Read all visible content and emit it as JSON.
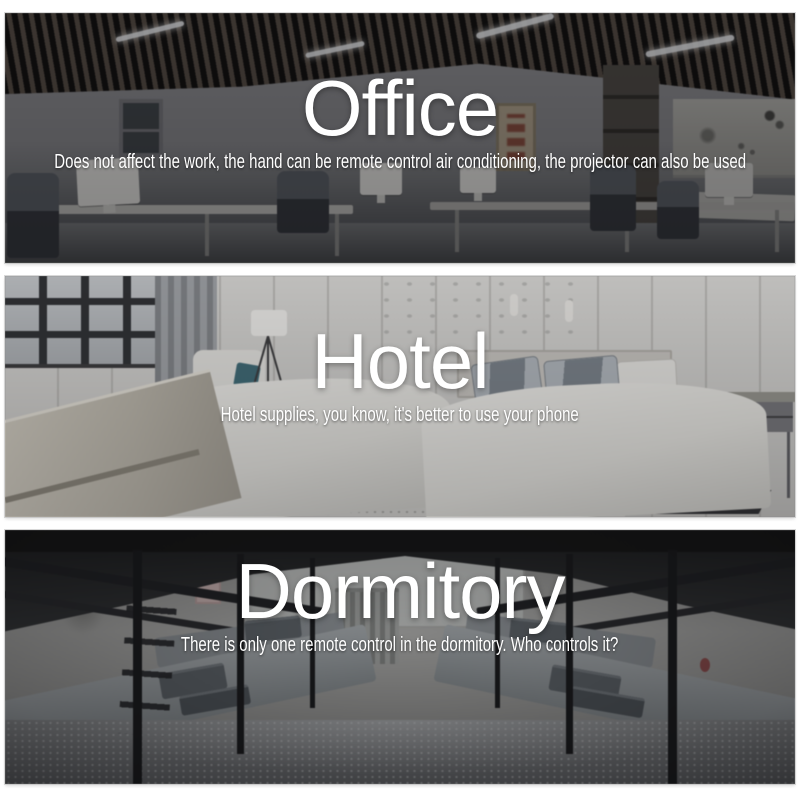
{
  "page": {
    "background": "#ffffff",
    "text_color": "#ffffff"
  },
  "panels": [
    {
      "name": "office",
      "title": "Office",
      "subtitle": "Does not affect the work, the hand can be remote control air conditioning, the projector can also be used"
    },
    {
      "name": "hotel",
      "title": "Hotel",
      "subtitle": "Hotel supplies, you know, it's better to use your phone"
    },
    {
      "name": "dormitory",
      "title": "Dormitory",
      "subtitle": "There is only one remote control in the dormitory. Who controls it?"
    }
  ]
}
